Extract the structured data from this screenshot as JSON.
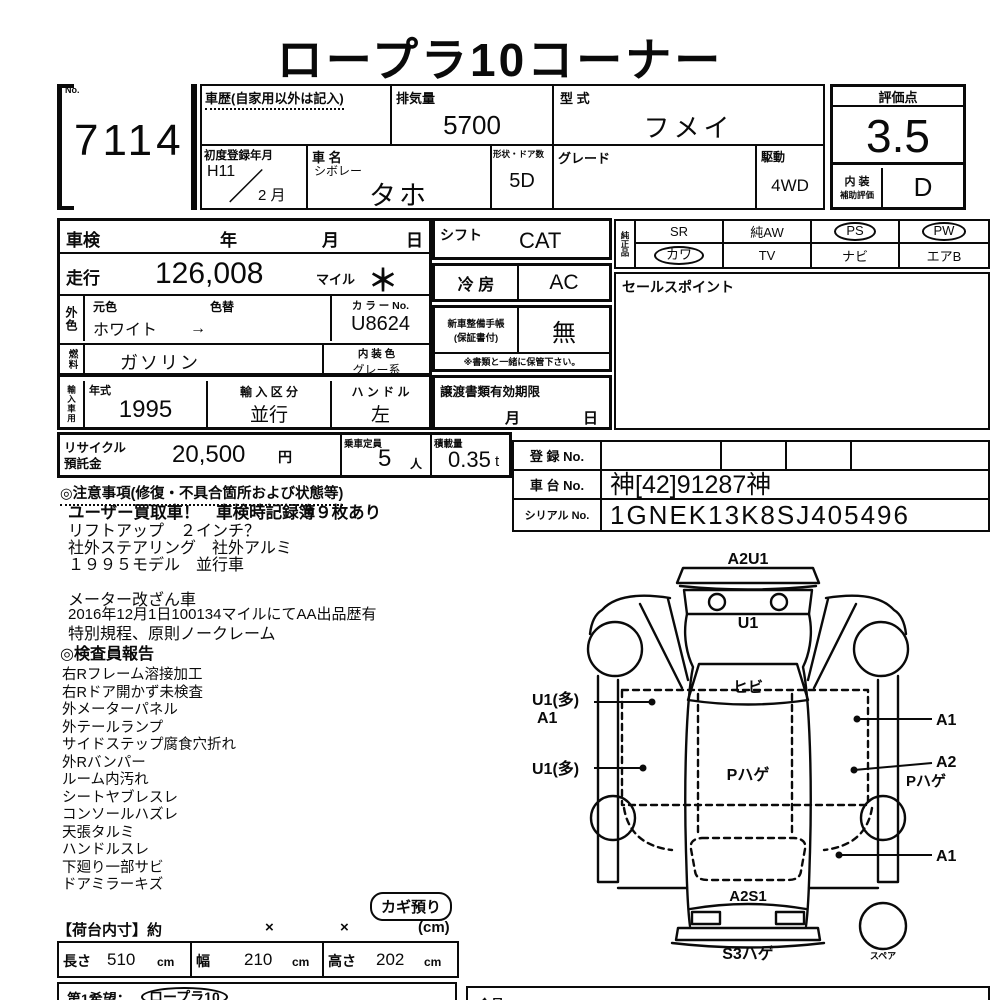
{
  "title": "ロープラ10コーナー",
  "lot": {
    "no_label": "No.",
    "number": "7114"
  },
  "header": {
    "history_label": "車歴(自家用以外は記入)",
    "displacement_label": "排気量",
    "displacement": "5700",
    "model_code_label": "型  式",
    "model_code": "フメイ",
    "first_reg_label": "初度登録年月",
    "first_reg_era": "H11",
    "first_reg_slash": "／",
    "first_reg_month": "2 月",
    "name_label": "車  名",
    "maker": "シボレー",
    "name": "タホ",
    "body_doors_label": "形状・ドア数",
    "body_doors": "5D",
    "grade_label": "グレード",
    "drive_label": "駆動",
    "drive": "4WD"
  },
  "rating": {
    "label": "評価点",
    "score": "3.5",
    "interior_label_top": "内 装",
    "interior_label_bottom": "補助評価",
    "interior_grade": "D"
  },
  "inspection": {
    "shaken_label": "車検",
    "shaken_year": "年",
    "shaken_month": "月",
    "shaken_day": "日",
    "mileage_label": "走行",
    "mileage": "126,008",
    "mileage_unit": "マイル",
    "mileage_mark": "＊",
    "ext_color_label": "外色",
    "orig_color_label": "元色",
    "recolor_label": "色替",
    "color_value": "ホワイト",
    "color_arrow": "→",
    "color_no_label": "カ ラ ー No.",
    "color_no": "U8624",
    "fuel_label": "燃料",
    "fuel": "ガソリン",
    "int_color_label": "内 装 色",
    "int_color": "グレー系",
    "import_label": "輸入車用",
    "year_label": "年式",
    "model_year": "1995",
    "import_class_label": "輸 入 区 分",
    "import_class": "並行",
    "handle_label": "ハ ン ド ル",
    "handle": "左"
  },
  "mid": {
    "shift_label": "シフト",
    "shift": "CAT",
    "ac_label": "冷 房",
    "ac": "AC",
    "record_label_1": "新車整備手帳",
    "record_label_2": "(保証書付)",
    "record": "無",
    "keep_note": "※書類と一緒に保管下さい。",
    "transfer_label": "譲渡書類有効期限",
    "transfer_month": "月",
    "transfer_day": "日"
  },
  "equipment": {
    "label": "純正品",
    "items": [
      "SR",
      "純AW",
      "PS",
      "PW",
      "カワ",
      "TV",
      "ナビ",
      "エアB"
    ],
    "circled": [
      false,
      false,
      true,
      true,
      true,
      false,
      false,
      false
    ],
    "sales_label": "セールスポイント"
  },
  "recycle": {
    "label_1": "リサイクル",
    "label_2": "預託金",
    "fee": "20,500",
    "fee_unit": "円",
    "capacity_label": "乗車定員",
    "capacity": "5",
    "capacity_unit": "人",
    "load_label": "積載量",
    "load": "0.35",
    "load_unit": "t"
  },
  "registration": {
    "reg_label": "登 録 No.",
    "chassis_label": "車 台 No.",
    "chassis_no": "神[42]91287神",
    "serial_label": "シリアル No.",
    "serial_no": "1GNEK13K8SJ405496"
  },
  "notes": {
    "heading": "◎注意事項(修復・不具合箇所および状態等)",
    "line_1": "ユーザー買取車！　車検時記録簿９枚あり",
    "line_2": "リフトアップ　２インチ？",
    "line_3": "社外ステアリング　社外アルミ",
    "line_4": "１９９５モデル　並行車",
    "line_5": "メーター改ざん車",
    "line_6": "2016年12月1日100134マイルにてAA出品歴有",
    "line_7": "特別規程、原則ノークレーム"
  },
  "inspector_report": {
    "heading": "◎検査員報告",
    "items": [
      "右Rフレーム溶接加工",
      "右Rドア開かず未検査",
      "外メーターパネル",
      "外テールランプ",
      "サイドステップ腐食穴折れ",
      "外Rバンパー",
      "ルーム内汚れ",
      "シートヤブレスレ",
      "コンソールハズレ",
      "天張タルミ",
      "ハンドルスレ",
      "下廻り一部サビ",
      "ドアミラーキズ"
    ],
    "key_badge": "カギ預り"
  },
  "diagram": {
    "front_label": "A2U1",
    "hood_label": "U1",
    "windshield_label": "ヒビ",
    "left_label_1": "U1(多)",
    "left_label_2": "A1",
    "left_label_3": "U1(多)",
    "roof_label": "Pハゲ",
    "right_label_1": "A1",
    "right_label_2": "A2",
    "right_label_3": "Pハゲ",
    "right_label_4": "A1",
    "rear_label": "A2S1",
    "rear_bottom_label": "S3ハゲ",
    "spare_label": "スペア"
  },
  "cargo": {
    "heading": "【荷台内寸】約",
    "times_1": "×",
    "times_2": "×",
    "unit_note": "(cm)",
    "length_label": "長さ",
    "length": "510",
    "length_unit": "cm",
    "width_label": "幅",
    "width": "210",
    "width_unit": "cm",
    "height_label": "高さ",
    "height": "202",
    "height_unit": "cm"
  },
  "footer": {
    "wish_label": "第1希望：",
    "wish_value": "ロープラ10",
    "member_label": "会員No"
  },
  "colors": {
    "ink": "#0a0a0a",
    "paper": "#ffffff"
  }
}
